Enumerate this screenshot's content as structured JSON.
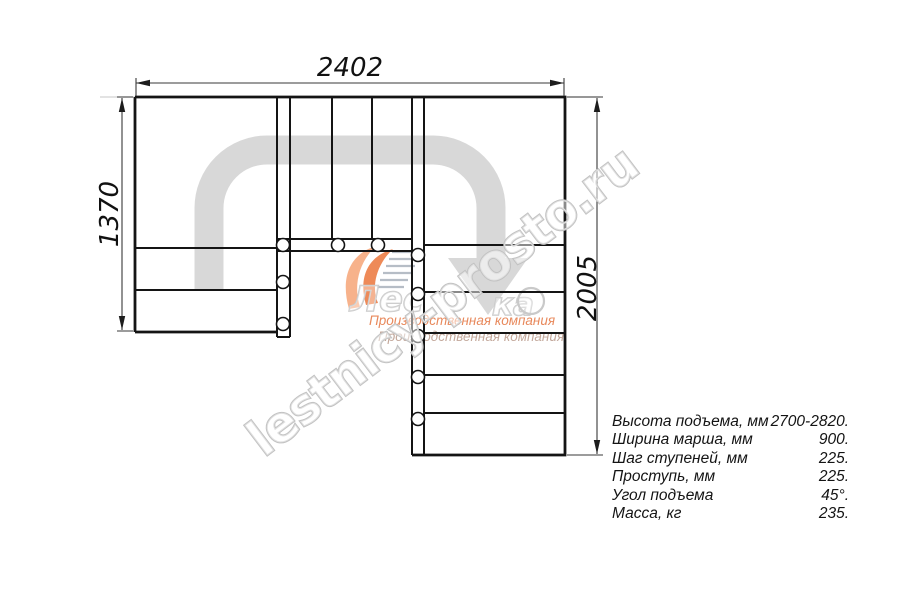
{
  "dims": {
    "top": "2402",
    "left": "1370",
    "right": "2005"
  },
  "watermark": {
    "text": "lestnicy-prosto.ru"
  },
  "logo": {
    "text_start": "Лес",
    "text_end": "ка",
    "company_orange": "Производственная компания",
    "company_gray": "Производственная компания"
  },
  "colors": {
    "line": "#141414",
    "direction_arrow": "#d8d8d8",
    "watermark_outline": "#c2c2c2",
    "logo_orange": "#ee8a58",
    "logo_orange_light": "#f7b28b",
    "company_text_orange": "#e8895c",
    "company_text_gray": "#c3a89b",
    "hatch_gray": "#b6bdc6"
  },
  "specs": {
    "rows": [
      {
        "label": "Высота подъема, мм",
        "value": "2700-2820."
      },
      {
        "label": "Ширина марша, мм",
        "value": "900."
      },
      {
        "label": "Шаг ступеней, мм",
        "value": "225."
      },
      {
        "label": "Проступь, мм",
        "value": "225."
      },
      {
        "label": "Угол подъема",
        "value": "45°."
      },
      {
        "label": "Масса, кг",
        "value": "235."
      }
    ]
  }
}
